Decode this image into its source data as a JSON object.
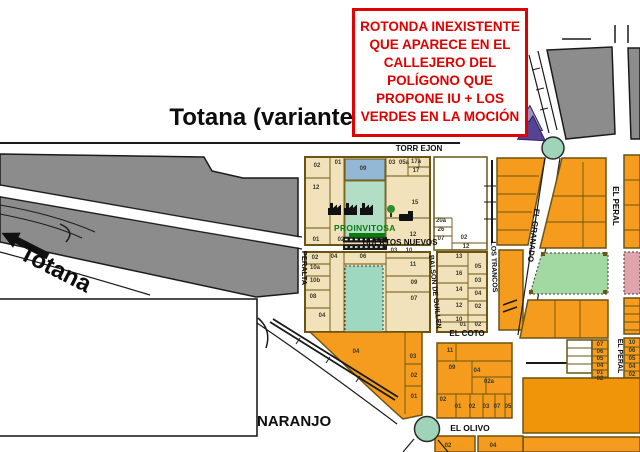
{
  "title": "Totana (variante",
  "annotation": {
    "lines": [
      "ROTONDA INEXISTENTE",
      "QUE APARECE EN EL",
      "CALLEJERO DEL",
      "POLÍGONO QUE",
      "PROPONE IU + LOS",
      "VERDES EN LA MOCIÓN"
    ]
  },
  "labels": {
    "totana_road": "Totana",
    "naranjo": "NARANJO",
    "proinvitosa": "PROINVITOSA"
  },
  "map": {
    "streets": [
      {
        "name": "TORR EJON",
        "x": 419,
        "y": 151,
        "rotate": 0,
        "size": 8
      },
      {
        "name": "HUERTOS NUEVOS",
        "x": 400,
        "y": 245,
        "rotate": 0,
        "size": 8
      },
      {
        "name": "PERALTA",
        "x": 302,
        "y": 268,
        "rotate": 90,
        "size": 7.5
      },
      {
        "name": "BALSON DE GUILLEN",
        "x": 433,
        "y": 292,
        "rotate": 84,
        "size": 7
      },
      {
        "name": "LOS TRANCOS",
        "x": 492,
        "y": 267,
        "rotate": 88,
        "size": 7
      },
      {
        "name": "EL COTO",
        "x": 467,
        "y": 336,
        "rotate": 0,
        "size": 8
      },
      {
        "name": "EL OLIVO",
        "x": 470,
        "y": 431,
        "rotate": 0,
        "size": 8.5
      },
      {
        "name": "EL GRANADO",
        "x": 531,
        "y": 235,
        "rotate": 97,
        "size": 8
      },
      {
        "name": "EL PERAL",
        "x": 613,
        "y": 206,
        "rotate": 90,
        "size": 8
      },
      {
        "name": "EL PERAL",
        "x": 618,
        "y": 356,
        "rotate": 90,
        "size": 7
      }
    ],
    "parcels": [
      {
        "n": "02",
        "x": 317,
        "y": 167
      },
      {
        "n": "01",
        "x": 338,
        "y": 164
      },
      {
        "n": "09",
        "x": 363,
        "y": 170
      },
      {
        "n": "03",
        "x": 392,
        "y": 164
      },
      {
        "n": "05a",
        "x": 404,
        "y": 164
      },
      {
        "n": "17a",
        "x": 416,
        "y": 163
      },
      {
        "n": "17",
        "x": 416,
        "y": 172
      },
      {
        "n": "15",
        "x": 415,
        "y": 204
      },
      {
        "n": "12",
        "x": 413,
        "y": 236
      },
      {
        "n": "12",
        "x": 316,
        "y": 189
      },
      {
        "n": "01",
        "x": 316,
        "y": 241
      },
      {
        "n": "02",
        "x": 341,
        "y": 241
      },
      {
        "n": "20a",
        "x": 441,
        "y": 222
      },
      {
        "n": "26",
        "x": 441,
        "y": 231
      },
      {
        "n": "07",
        "x": 441,
        "y": 240
      },
      {
        "n": "02",
        "x": 464,
        "y": 239
      },
      {
        "n": "12",
        "x": 466,
        "y": 248
      },
      {
        "n": "02",
        "x": 315,
        "y": 259
      },
      {
        "n": "04",
        "x": 334,
        "y": 258
      },
      {
        "n": "06",
        "x": 363,
        "y": 258
      },
      {
        "n": "03",
        "x": 394,
        "y": 252
      },
      {
        "n": "10",
        "x": 409,
        "y": 252
      },
      {
        "n": "10a",
        "x": 315,
        "y": 269
      },
      {
        "n": "10b",
        "x": 315,
        "y": 282
      },
      {
        "n": "08",
        "x": 313,
        "y": 298
      },
      {
        "n": "04",
        "x": 322,
        "y": 317
      },
      {
        "n": "11",
        "x": 413,
        "y": 266
      },
      {
        "n": "09",
        "x": 414,
        "y": 284
      },
      {
        "n": "07",
        "x": 414,
        "y": 300
      },
      {
        "n": "13",
        "x": 459,
        "y": 258
      },
      {
        "n": "16",
        "x": 459,
        "y": 275
      },
      {
        "n": "14",
        "x": 459,
        "y": 291
      },
      {
        "n": "12",
        "x": 459,
        "y": 307
      },
      {
        "n": "10",
        "x": 459,
        "y": 321
      },
      {
        "n": "05",
        "x": 478,
        "y": 268
      },
      {
        "n": "03",
        "x": 478,
        "y": 282
      },
      {
        "n": "04",
        "x": 478,
        "y": 295
      },
      {
        "n": "02",
        "x": 478,
        "y": 308
      },
      {
        "n": "01",
        "x": 463,
        "y": 326
      },
      {
        "n": "02",
        "x": 478,
        "y": 326
      },
      {
        "n": "04",
        "x": 356,
        "y": 353
      },
      {
        "n": "03",
        "x": 413,
        "y": 358
      },
      {
        "n": "02",
        "x": 414,
        "y": 377
      },
      {
        "n": "01",
        "x": 414,
        "y": 398
      },
      {
        "n": "11",
        "x": 450,
        "y": 352
      },
      {
        "n": "09",
        "x": 452,
        "y": 369
      },
      {
        "n": "04",
        "x": 477,
        "y": 372
      },
      {
        "n": "02a",
        "x": 489,
        "y": 383
      },
      {
        "n": "02",
        "x": 443,
        "y": 401
      },
      {
        "n": "01",
        "x": 458,
        "y": 408
      },
      {
        "n": "02",
        "x": 472,
        "y": 408
      },
      {
        "n": "03",
        "x": 486,
        "y": 408
      },
      {
        "n": "07",
        "x": 497,
        "y": 408
      },
      {
        "n": "05",
        "x": 508,
        "y": 408
      },
      {
        "n": "02",
        "x": 448,
        "y": 447
      },
      {
        "n": "04",
        "x": 493,
        "y": 447
      },
      {
        "n": "07",
        "x": 600,
        "y": 346
      },
      {
        "n": "06",
        "x": 600,
        "y": 353
      },
      {
        "n": "05",
        "x": 600,
        "y": 360
      },
      {
        "n": "04",
        "x": 600,
        "y": 367
      },
      {
        "n": "01",
        "x": 600,
        "y": 374
      },
      {
        "n": "02",
        "x": 600,
        "y": 380
      },
      {
        "n": "10",
        "x": 632,
        "y": 344
      },
      {
        "n": "06",
        "x": 632,
        "y": 352
      },
      {
        "n": "05",
        "x": 632,
        "y": 360
      },
      {
        "n": "04",
        "x": 632,
        "y": 368
      },
      {
        "n": "02",
        "x": 632,
        "y": 376
      }
    ]
  },
  "colors": {
    "map_gray": "#8c8c8c",
    "map_tan": "#f2e2bb",
    "map_orange": "#f59b1e",
    "map_orange_dark": "#f0940a",
    "border_olive": "#6b5510",
    "pool_blue": "#92b8d6",
    "zone_teal": "#9ed8c0",
    "zone_green": "#a2d8a2",
    "zone_pink": "#dfa4ac",
    "roundabout_green": "#9fd4b8",
    "arrow_purple": "#574394",
    "arrow_purple_light": "#9a93c4",
    "annotation_red": "#e00000",
    "proinvitosa_green": "#0c7a0c"
  }
}
